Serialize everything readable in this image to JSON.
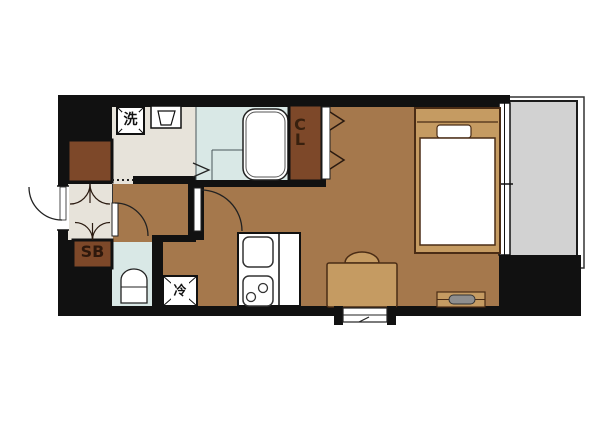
{
  "floorplan": {
    "labels": {
      "washing_machine": "洗",
      "closet": "CL",
      "shoe_box": "SB",
      "refrigerator": "冷"
    },
    "colors": {
      "wall": "#111111",
      "wood_floor": "#a5784c",
      "entry_floor": "#e7e3da",
      "wet_area_floor": "#d9e8e6",
      "storage_dark_brown": "#7d4829",
      "furniture_tan": "#c59b62",
      "balcony_gray": "#d2d2d2",
      "fixture_white": "#ffffff",
      "tv_gray": "#8e8e8e"
    }
  }
}
